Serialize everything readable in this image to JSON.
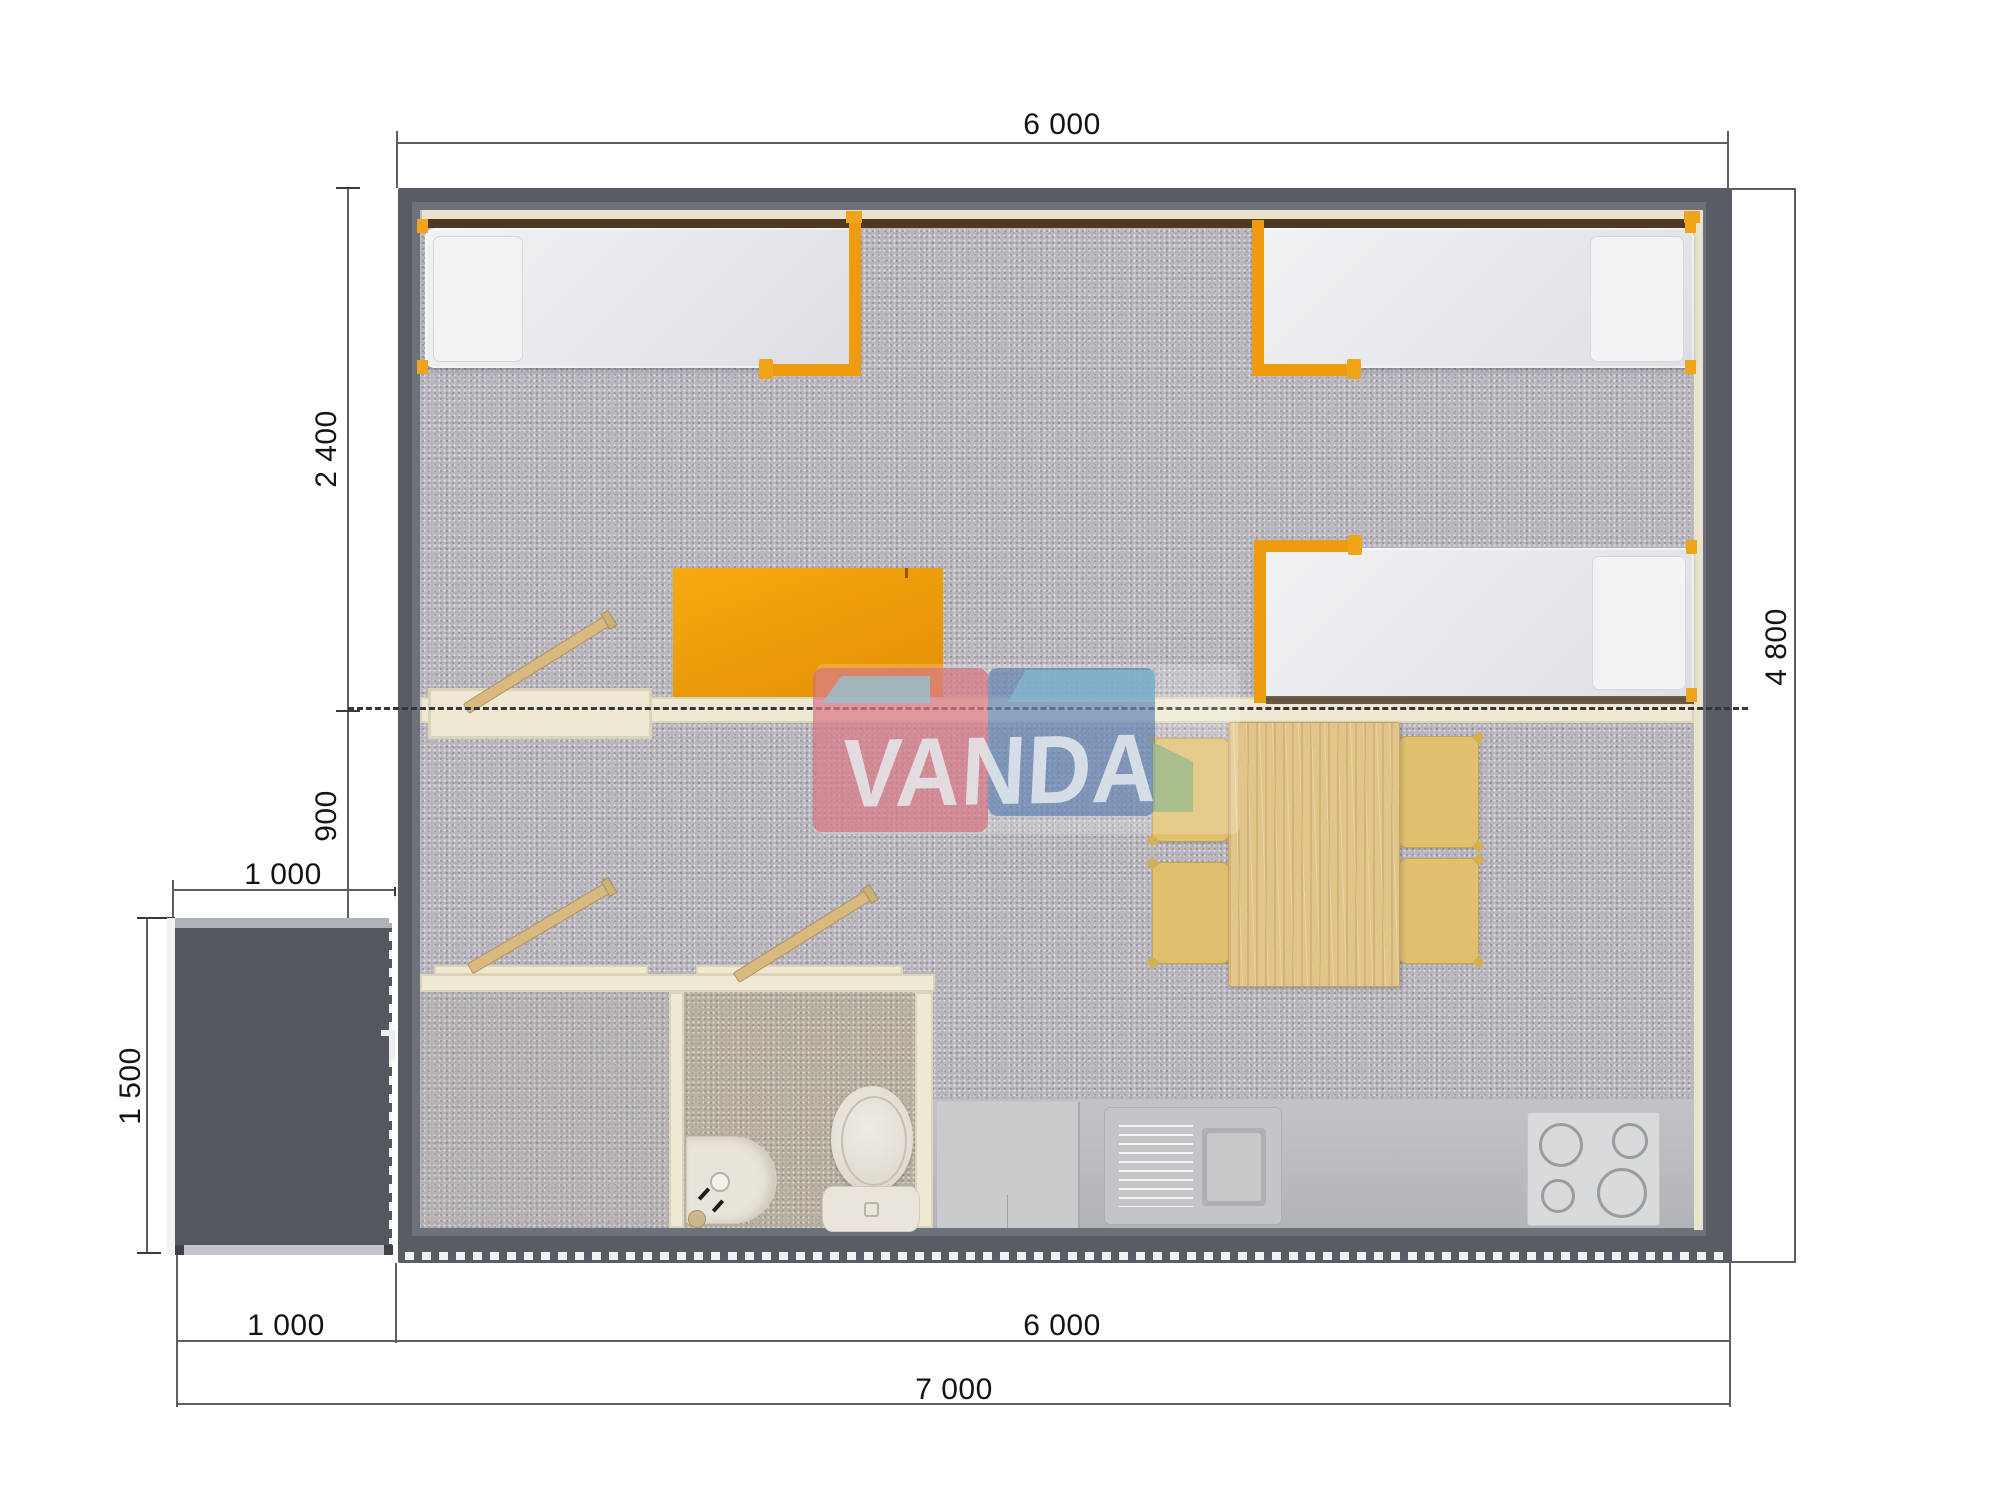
{
  "watermark": {
    "text": "VANDA"
  },
  "colors": {
    "accent_orange": "#ee9b10",
    "wall_slate": "#585c65",
    "carpet_gray": "#b9b6bd",
    "divider_cream": "#efe8d3",
    "logo_pink": "#d6707e",
    "logo_blue": "#587cae",
    "wood": "#e1c589"
  },
  "dimensions": {
    "top_width": {
      "label": "6 000"
    },
    "left_room_depth": {
      "label": "2 400"
    },
    "left_hall_depth": {
      "label": "900"
    },
    "porch_width": {
      "label": "1 000"
    },
    "porch_depth": {
      "label": "1 500"
    },
    "right_height": {
      "label": "4 800"
    },
    "bottom_porch": {
      "label": "1 000"
    },
    "bottom_building": {
      "label": "6 000"
    },
    "bottom_total": {
      "label": "7 000"
    }
  }
}
